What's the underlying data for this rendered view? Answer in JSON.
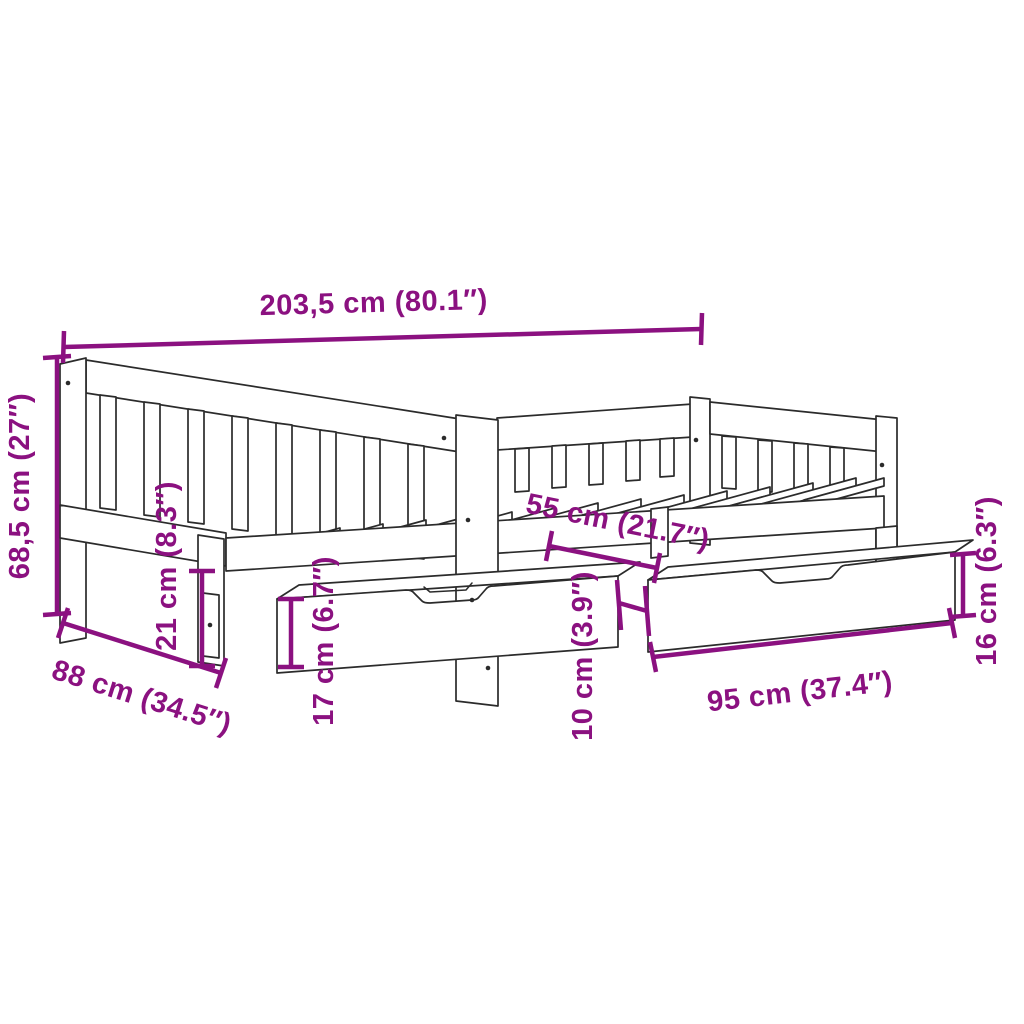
{
  "figure": {
    "name": "daybed-with-two-storage-drawers-dimension-diagram",
    "background_color": "#ffffff",
    "line_color": "#2b2b2b",
    "accent_color": "#8b1180",
    "dimensions": {
      "overall_length": "203,5 cm (80.1″)",
      "overall_height": "68,5 cm (27″)",
      "overall_depth": "88 cm (34.5″)",
      "underbed_clearance": "21 cm (8.3″)",
      "drawer_front_height": "17 cm (6.7″)",
      "drawer_depth": "55 cm (21.7″)",
      "drawer_gap": "10 cm (3.9″)",
      "drawer_width": "95 cm (37.4″)",
      "drawer_side_height": "16 cm (6.3″)"
    }
  }
}
